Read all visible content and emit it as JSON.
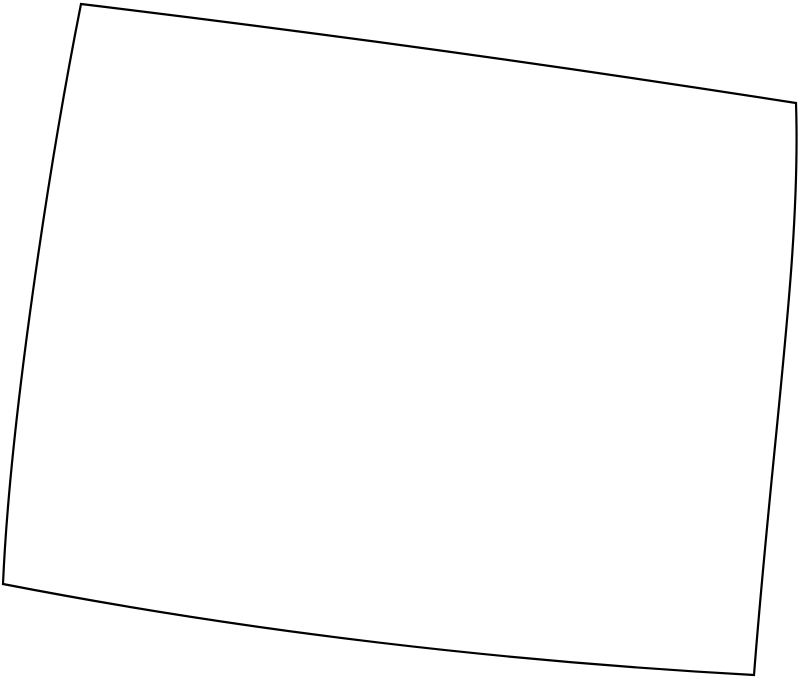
{
  "map": {
    "kind": "blank-state-outline-map",
    "region": "state-outline",
    "background_color": "#ffffff",
    "stroke_color": "#000000",
    "fill_color": "#ffffff",
    "stroke_width": "2.2",
    "canvas_width": "800",
    "canvas_height": "683",
    "viewbox": "0 0 800 683",
    "outline_path": "M 81,4 Q 438,47 796,103 C 801,255 773,430 754,675 C 500,661 250,632 3,584 C 10,420 50,160 81,4 Z",
    "corners": {
      "top_left": [
        81,
        4
      ],
      "top_right": [
        796,
        103
      ],
      "bottom_right": [
        754,
        675
      ],
      "bottom_left": [
        3,
        584
      ]
    }
  }
}
